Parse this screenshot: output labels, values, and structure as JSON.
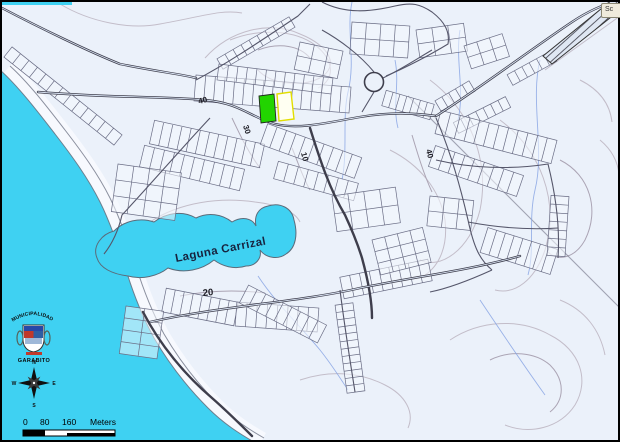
{
  "colors": {
    "ocean": "#3FD1F2",
    "land": "#EBF1FA",
    "highlight_green": "#22D400",
    "highlight_yellow_fill": "#FFFFF2",
    "highlight_yellow_border": "#E2DE00",
    "road": "#3E3E4C",
    "contour": "#C3BDC9",
    "frame": "#000000"
  },
  "map": {
    "lagoon_label": "Laguna Carrizal",
    "contour_labels": [
      {
        "text": "40"
      },
      {
        "text": "30"
      },
      {
        "text": "10"
      },
      {
        "text": "40"
      },
      {
        "text": "20"
      }
    ]
  },
  "legend": {
    "municipality_line1": "MUNICIPALIDAD",
    "municipality_line2": "GARABITO",
    "compass": {
      "north": "N",
      "south": "S",
      "east": "E",
      "west": "W"
    },
    "scalebar": {
      "tick0": "0",
      "tick1": "80",
      "tick2": "160",
      "unit": "Meters"
    }
  },
  "toolbar": {
    "clipped_button_text": "Sc"
  }
}
